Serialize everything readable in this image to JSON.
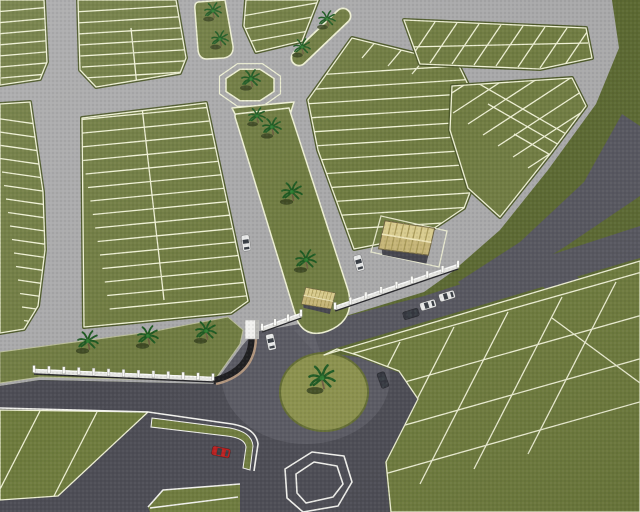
{
  "meta": {
    "scene_type": "aerial-3d-render-of-gated-subdivision-site-plan"
  },
  "palette": {
    "extgreen": "#5b6831",
    "fieldgreen": "#6e7b3d",
    "parcel": "#707c42",
    "rim": "#4e5a2b",
    "lotline": "#eef0d4",
    "roadgray": "#a9a9aa",
    "pavement": "#4c4c54",
    "band": "#56565f",
    "islandlight": "#8b914d",
    "islandrim": "#636d33",
    "whitemark": "#f2f2ee",
    "wallwhite": "#e6e6e2",
    "wallshadow": "#26262a",
    "curvedark": "#1e1e20",
    "curvetan": "#b3977f",
    "palmfrond": "#1e5a22",
    "palmcore": "#2f7d31",
    "palmshadow": "#37431f",
    "trunk": "#6d5c40",
    "roofa": "#d9cc8e",
    "roofb": "#c6b577",
    "roofstripe": "#a99a58",
    "roofridge": "#efe6b8",
    "housewall": "#45454d",
    "carwhite": "#e9eaea",
    "cardark": "#33353d",
    "carred": "#bb1f1f",
    "carglass": "#383d44"
  },
  "scene": {
    "roundabouts": [
      {
        "name": "upper-octagon-roundabout",
        "cx": 250,
        "cy": 85,
        "palms": 1
      },
      {
        "name": "lower-roundabout",
        "cx": 324,
        "cy": 392,
        "rx": 44,
        "ry": 39,
        "palms": 1
      }
    ],
    "palms": [
      {
        "x": 213,
        "y": 11,
        "s": 0.9
      },
      {
        "x": 220,
        "y": 39,
        "s": 0.9
      },
      {
        "x": 302,
        "y": 47,
        "s": 0.9
      },
      {
        "x": 327,
        "y": 19,
        "s": 0.9
      },
      {
        "x": 251,
        "y": 79,
        "s": 1.0
      },
      {
        "x": 257,
        "y": 116,
        "s": 0.9
      },
      {
        "x": 272,
        "y": 127,
        "s": 1.0
      },
      {
        "x": 292,
        "y": 192,
        "s": 1.1
      },
      {
        "x": 306,
        "y": 260,
        "s": 1.1
      },
      {
        "x": 88,
        "y": 341,
        "s": 1.1
      },
      {
        "x": 148,
        "y": 336,
        "s": 1.1
      },
      {
        "x": 206,
        "y": 331,
        "s": 1.1
      },
      {
        "x": 322,
        "y": 378,
        "s": 1.4
      }
    ],
    "cars": [
      {
        "x": 246,
        "y": 243,
        "rot": 82,
        "body": "carwhite"
      },
      {
        "x": 271,
        "y": 342,
        "rot": 78,
        "body": "carwhite"
      },
      {
        "x": 359,
        "y": 263,
        "rot": 74,
        "body": "carwhite"
      },
      {
        "x": 447,
        "y": 296,
        "rot": -17,
        "body": "carwhite"
      },
      {
        "x": 428,
        "y": 305,
        "rot": -17,
        "body": "carwhite"
      },
      {
        "x": 411,
        "y": 314,
        "rot": -17,
        "body": "cardark"
      },
      {
        "x": 383,
        "y": 380,
        "rot": 70,
        "body": "cardark"
      },
      {
        "x": 221,
        "y": 452,
        "rot": 12,
        "body": "carred",
        "s": 1.15
      }
    ],
    "buildings": [
      {
        "name": "gatehouse",
        "x": 318,
        "y": 300,
        "s": 0.75,
        "rot": 15
      },
      {
        "name": "main-house",
        "x": 406,
        "y": 241,
        "s": 1.25,
        "rot": 13
      }
    ],
    "walls": [
      {
        "x1": 34,
        "y1": 371,
        "x2": 213,
        "y2": 379,
        "posts": 13
      },
      {
        "x1": 335,
        "y1": 308,
        "x2": 458,
        "y2": 266,
        "posts": 9
      },
      {
        "x1": 262,
        "y1": 329,
        "x2": 301,
        "y2": 315,
        "posts": 4
      }
    ],
    "pillars": [
      {
        "x": 245,
        "y": 320
      }
    ],
    "lot_line_sets": [
      {
        "block": "b1",
        "x0": -6,
        "y0": 12,
        "sx": 1.2,
        "sy": 11,
        "dx": 58,
        "dy": -5,
        "n": 7
      },
      {
        "block": "b2",
        "x0": 74,
        "y0": 12,
        "sx": 1.6,
        "sy": 11,
        "dx": 118,
        "dy": -7,
        "n": 7
      },
      {
        "block": "b3",
        "x0": 242,
        "y0": 16,
        "sx": 2,
        "sy": 13,
        "dx": 80,
        "dy": -14,
        "n": 3
      },
      {
        "block": "b4",
        "x0": -6,
        "y0": 118,
        "sx": 2,
        "sy": 13.5,
        "dx": 56,
        "dy": 8,
        "n": 16
      },
      {
        "block": "b5",
        "x0": 76,
        "y0": 120,
        "sx": 2.4,
        "sy": 13.5,
        "dx": 178,
        "dy": -17,
        "n": 15
      },
      {
        "block": "bf",
        "x0": 298,
        "y0": 76,
        "sx": 3,
        "sy": 14,
        "dx": 208,
        "dy": -13,
        "n": 12
      },
      {
        "block": "bg",
        "x0": 408,
        "y0": 62,
        "sx": 22,
        "sy": 1,
        "dx": 27,
        "dy": -40,
        "n": 9
      },
      {
        "block": "bh",
        "x0": 438,
        "y0": 102,
        "sx": 15,
        "sy": 11,
        "dx": 135,
        "dy": -88,
        "n": 8
      },
      {
        "block": "bh",
        "x0": 462,
        "y0": 74,
        "sx": 26,
        "sy": 30,
        "dx": 118,
        "dy": 68,
        "n": 3
      },
      {
        "block": "field",
        "x0": 400,
        "y0": 342,
        "sx": 54,
        "sy": -15,
        "dx": -88,
        "dy": 172,
        "n": 5
      },
      {
        "block": "field",
        "x0": 330,
        "y0": 360,
        "sx": 11,
        "sy": 40,
        "dx": 312,
        "dy": -88,
        "n": 4
      },
      {
        "block": "wedge",
        "x0": 40,
        "y0": 411,
        "sx": 57,
        "sy": 1,
        "dx": -44,
        "dy": 86,
        "n": 2
      }
    ],
    "extra_lines": [
      {
        "block": "b2",
        "x1": 131,
        "y1": 28,
        "x2": 137,
        "y2": 86
      },
      {
        "block": "b5",
        "x1": 142,
        "y1": 107,
        "x2": 164,
        "y2": 300
      },
      {
        "block": "bf",
        "x1": 362,
        "y1": 58,
        "x2": 388,
        "y2": 27
      },
      {
        "block": "bf",
        "x1": 388,
        "y1": 66,
        "x2": 414,
        "y2": 35
      },
      {
        "block": "bf",
        "x1": 412,
        "y1": 74,
        "x2": 438,
        "y2": 43
      },
      {
        "block": "bg",
        "x1": 408,
        "y1": 47,
        "x2": 588,
        "y2": 43
      },
      {
        "block": "field",
        "x1": 552,
        "y1": 318,
        "x2": 640,
        "y2": 383
      }
    ]
  }
}
